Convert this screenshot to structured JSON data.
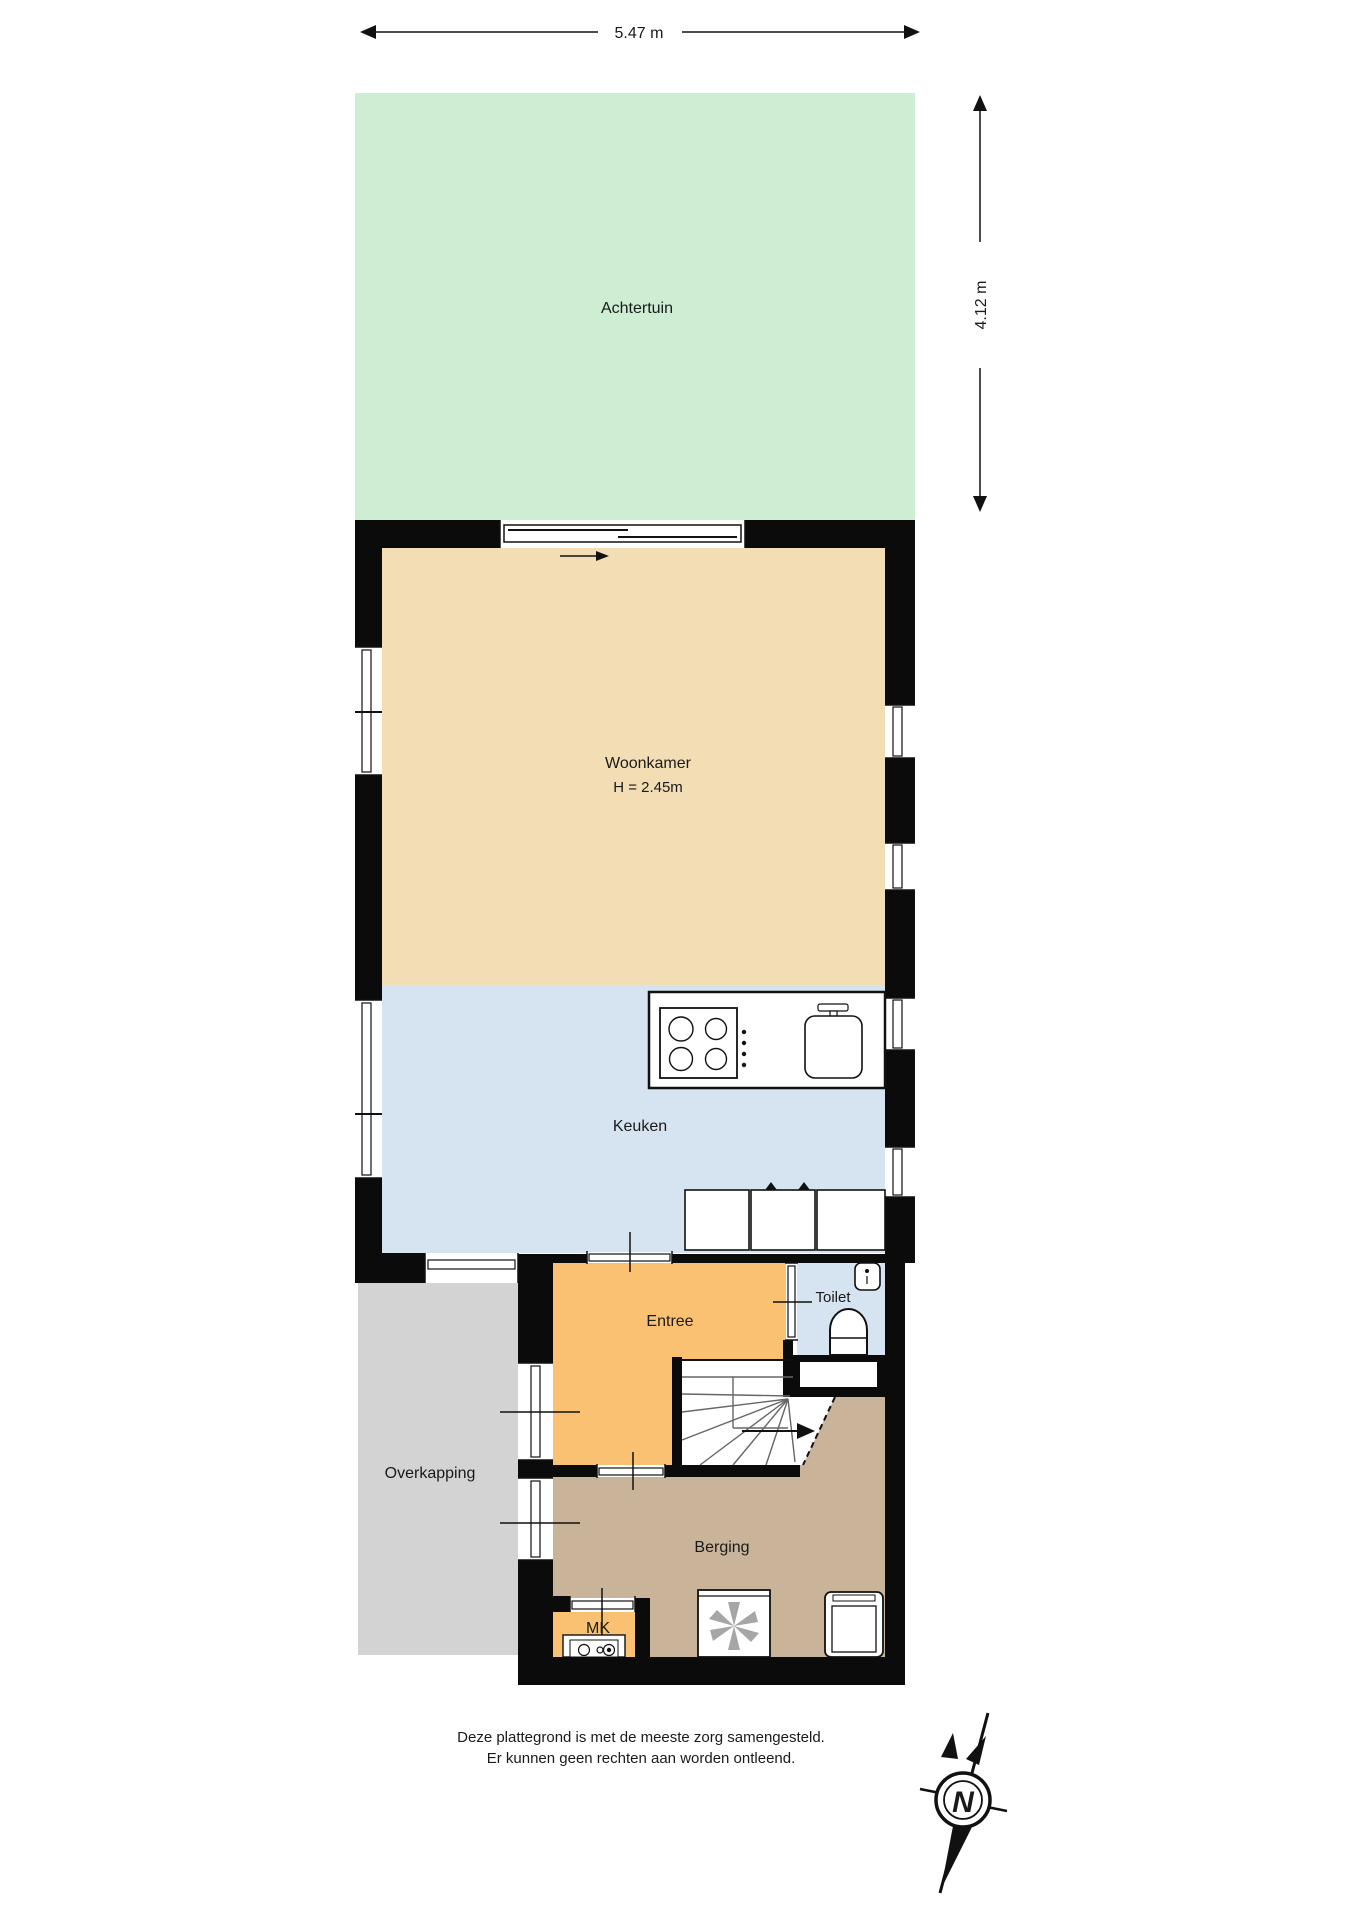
{
  "dimensions": {
    "width_label": "5.47 m",
    "height_label": "4.12 m"
  },
  "rooms": {
    "achtertuin": {
      "label": "Achtertuin"
    },
    "woonkamer": {
      "label": "Woonkamer",
      "ceiling_height": "H = 2.45m"
    },
    "keuken": {
      "label": "Keuken"
    },
    "entree": {
      "label": "Entree"
    },
    "toilet": {
      "label": "Toilet"
    },
    "overkapping": {
      "label": "Overkapping"
    },
    "berging": {
      "label": "Berging"
    },
    "meterkast": {
      "label": "MK"
    }
  },
  "compass": {
    "north_label": "N"
  },
  "disclaimer": {
    "line1": "Deze plattegrond is met de meeste zorg samengesteld.",
    "line2": "Er kunnen geen rechten aan worden ontleend."
  },
  "colors": {
    "garden": "#cdeed2",
    "living": "#f2ddb4",
    "kitchen": "#d6e3f0",
    "toilet": "#d6e3f0",
    "entry": "#f9c171",
    "meterkast": "#f9c171",
    "storage": "#c9b49a",
    "canopy": "#d3d3d3",
    "wall": "#0b0b0b"
  }
}
